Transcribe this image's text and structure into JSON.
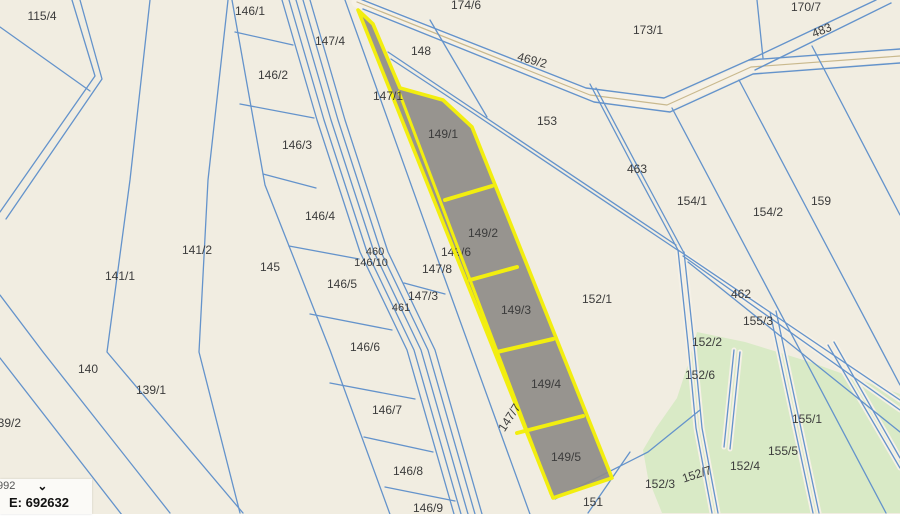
{
  "app": {
    "title": "cadastral parcel map viewer"
  },
  "coordinate_widget": {
    "system_text_partial": "992",
    "chevron_icon": "chevron-down",
    "easting": "E: 692632"
  },
  "map": {
    "width": 900,
    "height": 514,
    "colors": {
      "bg": "#f1ede1",
      "line": "#6493cb",
      "road_fill": "#f6f1e6",
      "road_center": "#c9b98e",
      "green": "#d9eac6",
      "gray": "#8f8c88",
      "yellow": "#f2ee0f",
      "label": "#3c3c3c",
      "page": "#ffffff"
    },
    "highlighted_parcels": [
      "149/1",
      "149/2",
      "149/3",
      "149/4",
      "149/5"
    ],
    "road": {
      "casing": [
        [
          357,
          2
        ],
        [
          590,
          95
        ],
        [
          667,
          105
        ],
        [
          751,
          67
        ],
        [
          900,
          56
        ]
      ],
      "edges": [
        [
          [
            350,
            -5
          ],
          [
            586,
            88
          ],
          [
            664,
            98
          ],
          [
            749,
            60
          ],
          [
            900,
            49
          ]
        ],
        [
          [
            363,
            9
          ],
          [
            594,
            102
          ],
          [
            670,
            112
          ],
          [
            753,
            74
          ],
          [
            900,
            63
          ]
        ]
      ]
    },
    "branch_483": [
      [
        [
          749,
          60
        ],
        [
          876,
          0
        ]
      ],
      [
        [
          755,
          70
        ],
        [
          891,
          3
        ]
      ]
    ],
    "lines": [
      {
        "p": [
          [
            0,
            27
          ],
          [
            90,
            91
          ]
        ]
      },
      {
        "p": [
          [
            0,
            295
          ],
          [
            43,
            352
          ],
          [
            170,
            513
          ]
        ]
      },
      {
        "p": [
          [
            0,
            358
          ],
          [
            122,
            515
          ]
        ]
      },
      {
        "p": [
          [
            150,
            0
          ],
          [
            130,
            180
          ],
          [
            107,
            352
          ],
          [
            243,
            513
          ]
        ]
      },
      {
        "p": [
          [
            228,
            0
          ],
          [
            208,
            180
          ],
          [
            199,
            352
          ],
          [
            240,
            513
          ]
        ]
      },
      {
        "p": [
          [
            232,
            0
          ],
          [
            265,
            185
          ],
          [
            330,
            350
          ],
          [
            395,
            528
          ]
        ]
      },
      {
        "p": [
          [
            282,
            0
          ],
          [
            317,
            120
          ],
          [
            360,
            252
          ],
          [
            407,
            350
          ],
          [
            458,
            528
          ]
        ]
      },
      {
        "p": [
          [
            289,
            0
          ],
          [
            324,
            120
          ],
          [
            367,
            252
          ],
          [
            414,
            350
          ],
          [
            465,
            528
          ]
        ]
      },
      {
        "p": [
          [
            296,
            0
          ],
          [
            331,
            120
          ],
          [
            374,
            252
          ],
          [
            421,
            350
          ],
          [
            472,
            528
          ]
        ]
      },
      {
        "p": [
          [
            303,
            0
          ],
          [
            338,
            120
          ],
          [
            381,
            252
          ],
          [
            428,
            350
          ],
          [
            479,
            528
          ]
        ]
      },
      {
        "p": [
          [
            310,
            0
          ],
          [
            345,
            120
          ],
          [
            388,
            252
          ],
          [
            435,
            350
          ],
          [
            486,
            528
          ]
        ]
      },
      {
        "p": [
          [
            345,
            0
          ],
          [
            438,
            260
          ],
          [
            535,
            528
          ]
        ]
      },
      {
        "p": [
          [
            235,
            32
          ],
          [
            293,
            45
          ]
        ]
      },
      {
        "p": [
          [
            240,
            104
          ],
          [
            314,
            118
          ]
        ]
      },
      {
        "p": [
          [
            263,
            174
          ],
          [
            316,
            188
          ]
        ]
      },
      {
        "p": [
          [
            289,
            246
          ],
          [
            359,
            259
          ]
        ]
      },
      {
        "p": [
          [
            310,
            314
          ],
          [
            392,
            330
          ]
        ]
      },
      {
        "p": [
          [
            330,
            383
          ],
          [
            415,
            399
          ]
        ]
      },
      {
        "p": [
          [
            364,
            437
          ],
          [
            433,
            452
          ]
        ]
      },
      {
        "p": [
          [
            385,
            487
          ],
          [
            455,
            501
          ]
        ]
      },
      {
        "p": [
          [
            404,
            283
          ],
          [
            445,
            294
          ]
        ]
      },
      {
        "p": [
          [
            430,
            20
          ],
          [
            487,
            117
          ]
        ]
      },
      {
        "p": [
          [
            672,
            108
          ],
          [
            886,
            513
          ]
        ]
      },
      {
        "p": [
          [
            739,
            80
          ],
          [
            900,
            385
          ]
        ]
      },
      {
        "p": [
          [
            812,
            46
          ],
          [
            900,
            215
          ]
        ]
      },
      {
        "p": [
          [
            757,
            0
          ],
          [
            763,
            58
          ]
        ]
      },
      {
        "p": [
          [
            688,
            262
          ],
          [
            900,
            432
          ]
        ]
      },
      {
        "p": [
          [
            555,
            499
          ],
          [
            648,
            452
          ],
          [
            700,
            410
          ]
        ]
      },
      {
        "p": [
          [
            630,
            452
          ],
          [
            588,
            513
          ]
        ]
      }
    ],
    "double_paths": [
      {
        "a": [
          [
            72,
            0
          ],
          [
            95,
            76
          ],
          [
            0,
            212
          ]
        ],
        "b": [
          [
            80,
            0
          ],
          [
            102,
            79
          ],
          [
            6,
            219
          ]
        ],
        "casing": false
      },
      {
        "a": [
          [
            590,
            84
          ],
          [
            634,
            168
          ],
          [
            678,
            250
          ]
        ],
        "b": [
          [
            596,
            88
          ],
          [
            640,
            171
          ],
          [
            684,
            253
          ]
        ],
        "casing": false
      },
      {
        "a": [
          [
            388,
            52
          ],
          [
            470,
            107
          ],
          [
            676,
            245
          ]
        ],
        "b": [
          [
            391,
            59
          ],
          [
            473,
            113
          ],
          [
            679,
            251
          ]
        ],
        "casing": false
      },
      {
        "a": [
          [
            678,
            250
          ],
          [
            900,
            400
          ]
        ],
        "b": [
          [
            683,
            256
          ],
          [
            900,
            410
          ]
        ],
        "casing": true
      },
      {
        "a": [
          [
            678,
            250
          ],
          [
            688,
            344
          ],
          [
            696,
            428
          ],
          [
            712,
            513
          ]
        ],
        "b": [
          [
            684,
            252
          ],
          [
            694,
            345
          ],
          [
            702,
            428
          ],
          [
            718,
            513
          ]
        ],
        "casing": true
      },
      {
        "a": [
          [
            734,
            350
          ],
          [
            724,
            447
          ]
        ],
        "b": [
          [
            740,
            352
          ],
          [
            730,
            449
          ]
        ],
        "casing": true
      },
      {
        "a": [
          [
            770,
            312
          ],
          [
            813,
            513
          ]
        ],
        "b": [
          [
            776,
            311
          ],
          [
            819,
            513
          ]
        ],
        "casing": true
      },
      {
        "a": [
          [
            828,
            345
          ],
          [
            900,
            468
          ]
        ],
        "b": [
          [
            834,
            342
          ],
          [
            900,
            458
          ]
        ],
        "casing": true
      }
    ],
    "green_area": [
      [
        697,
        332
      ],
      [
        745,
        342
      ],
      [
        810,
        362
      ],
      [
        860,
        380
      ],
      [
        900,
        394
      ],
      [
        900,
        513
      ],
      [
        662,
        513
      ],
      [
        648,
        478
      ],
      [
        643,
        450
      ],
      [
        656,
        428
      ],
      [
        677,
        398
      ],
      [
        690,
        358
      ]
    ],
    "highlight": {
      "outer": [
        [
          358,
          10
        ],
        [
          373,
          24
        ],
        [
          400,
          88
        ],
        [
          443,
          100
        ],
        [
          472,
          127
        ],
        [
          612,
          478
        ],
        [
          553,
          498
        ]
      ],
      "divider": [
        [
          399,
          92
        ],
        [
          551,
          494
        ]
      ],
      "rungs": [
        [
          [
            445,
            200
          ],
          [
            492,
            186
          ]
        ],
        [
          [
            470,
            280
          ],
          [
            517,
            267
          ]
        ],
        [
          [
            497,
            352
          ],
          [
            553,
            339
          ]
        ],
        [
          [
            517,
            433
          ],
          [
            583,
            416
          ]
        ]
      ]
    },
    "label_under_highlight": {
      "text": "149/6",
      "x": 456,
      "y": 253
    },
    "labels": [
      {
        "text": "115/4",
        "x": 42,
        "y": 17
      },
      {
        "text": "146/1",
        "x": 250,
        "y": 12
      },
      {
        "text": "174/6",
        "x": 466,
        "y": 6
      },
      {
        "text": "170/7",
        "x": 806,
        "y": 8
      },
      {
        "text": "483",
        "x": 822,
        "y": 31,
        "rot": -22
      },
      {
        "text": "173/1",
        "x": 648,
        "y": 31
      },
      {
        "text": "147/4",
        "x": 330,
        "y": 42
      },
      {
        "text": "148",
        "x": 421,
        "y": 52
      },
      {
        "text": "469/2",
        "x": 532,
        "y": 61,
        "rot": 15
      },
      {
        "text": "146/2",
        "x": 273,
        "y": 76
      },
      {
        "text": "147/1",
        "x": 388,
        "y": 97
      },
      {
        "text": "153",
        "x": 547,
        "y": 122
      },
      {
        "text": "149/1",
        "x": 443,
        "y": 135
      },
      {
        "text": "146/3",
        "x": 297,
        "y": 146
      },
      {
        "text": "463",
        "x": 637,
        "y": 170
      },
      {
        "text": "154/1",
        "x": 692,
        "y": 202
      },
      {
        "text": "159",
        "x": 821,
        "y": 202
      },
      {
        "text": "154/2",
        "x": 768,
        "y": 213
      },
      {
        "text": "146/4",
        "x": 320,
        "y": 217
      },
      {
        "text": "149/2",
        "x": 483,
        "y": 234
      },
      {
        "text": "141/2",
        "x": 197,
        "y": 251
      },
      {
        "text": "460",
        "x": 375,
        "y": 252,
        "size": 11
      },
      {
        "text": "146/10",
        "x": 371,
        "y": 263,
        "size": 11
      },
      {
        "text": "145",
        "x": 270,
        "y": 268
      },
      {
        "text": "147/8",
        "x": 437,
        "y": 270
      },
      {
        "text": "141/1",
        "x": 120,
        "y": 277
      },
      {
        "text": "146/5",
        "x": 342,
        "y": 285
      },
      {
        "text": "147/3",
        "x": 423,
        "y": 297
      },
      {
        "text": "152/1",
        "x": 597,
        "y": 300
      },
      {
        "text": "462",
        "x": 741,
        "y": 295
      },
      {
        "text": "461",
        "x": 401,
        "y": 308,
        "size": 11
      },
      {
        "text": "149/3",
        "x": 516,
        "y": 311
      },
      {
        "text": "155/3",
        "x": 758,
        "y": 322
      },
      {
        "text": "146/6",
        "x": 365,
        "y": 348
      },
      {
        "text": "152/2",
        "x": 707,
        "y": 343
      },
      {
        "text": "152/6",
        "x": 700,
        "y": 376
      },
      {
        "text": "140",
        "x": 88,
        "y": 370
      },
      {
        "text": "149/4",
        "x": 546,
        "y": 385
      },
      {
        "text": "139/1",
        "x": 151,
        "y": 391
      },
      {
        "text": "146/7",
        "x": 387,
        "y": 411
      },
      {
        "text": "147/7",
        "x": 510,
        "y": 418,
        "rot": -57
      },
      {
        "text": "155/1",
        "x": 807,
        "y": 420
      },
      {
        "text": "139/2",
        "x": 6,
        "y": 424
      },
      {
        "text": "155/5",
        "x": 783,
        "y": 452
      },
      {
        "text": "149/5",
        "x": 566,
        "y": 458
      },
      {
        "text": "152/4",
        "x": 745,
        "y": 467
      },
      {
        "text": "146/8",
        "x": 408,
        "y": 472
      },
      {
        "text": "152/7",
        "x": 697,
        "y": 475,
        "rot": -18
      },
      {
        "text": "152/3",
        "x": 660,
        "y": 485
      },
      {
        "text": "151",
        "x": 593,
        "y": 503
      },
      {
        "text": "146/9",
        "x": 428,
        "y": 509
      }
    ]
  }
}
